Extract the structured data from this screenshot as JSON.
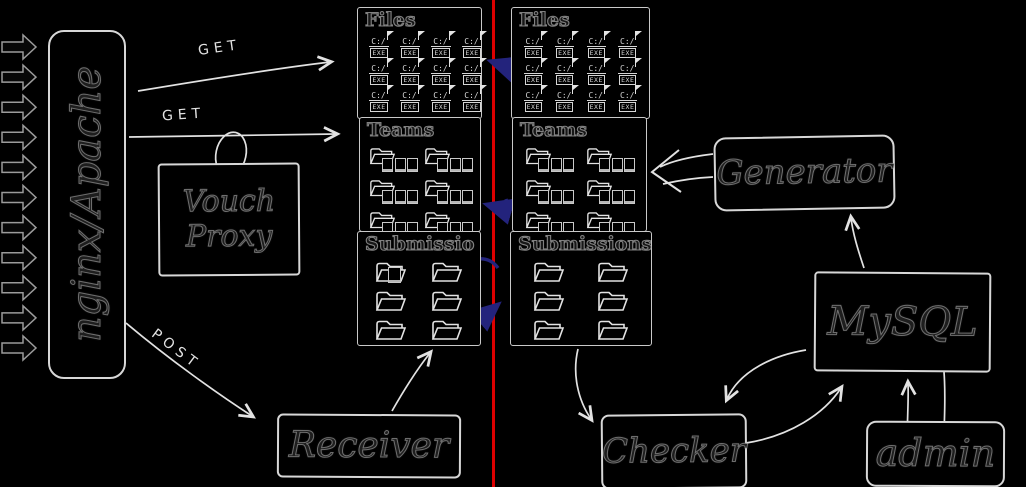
{
  "nodes": {
    "gateway": {
      "label": "nginx/Apache"
    },
    "vouch_proxy": {
      "label": "Vouch Proxy"
    },
    "receiver": {
      "label": "Receiver"
    },
    "generator": {
      "label": "Generator"
    },
    "mysql": {
      "label": "MySQL"
    },
    "checker": {
      "label": "Checker"
    },
    "admin": {
      "label": "admin"
    }
  },
  "edge_labels": {
    "get_files": "GET",
    "get_teams": "GET",
    "post": "POST"
  },
  "gateway_inbound": {
    "arrow_count": 11
  },
  "icons": {
    "exe_drive": "C:/",
    "exe_label": "EXE"
  },
  "panels": {
    "left_files": {
      "title": "Files",
      "icon": "exe",
      "count": 12,
      "cols": 4
    },
    "left_teams": {
      "title": "Teams",
      "icon": "team",
      "count": 6,
      "cols": 2
    },
    "left_submissions": {
      "title": "Submissio",
      "icon": "folder",
      "count": 6,
      "cols": 2,
      "overlay_exe_on_first": true
    },
    "right_files": {
      "title": "Files",
      "icon": "exe",
      "count": 12,
      "cols": 4
    },
    "right_teams": {
      "title": "Teams",
      "icon": "team",
      "count": 6,
      "cols": 2
    },
    "right_submissions": {
      "title": "Submissions",
      "icon": "folder",
      "count": 6,
      "cols": 2
    }
  },
  "colors": {
    "background": "#000000",
    "divider_line": "#dd0000",
    "sync_arrow": "#23237c",
    "sketch_stroke": "#e2e2e2",
    "ink_fill": "#1e1e1e"
  }
}
